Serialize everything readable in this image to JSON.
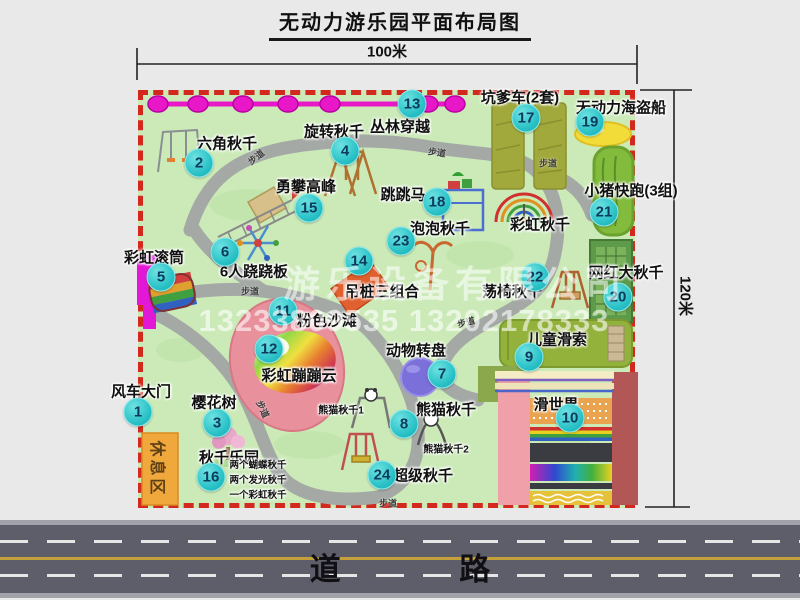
{
  "title": "无动力游乐园平面布局图",
  "dimensions": {
    "width_label": "100米",
    "height_label": "120米"
  },
  "road": {
    "label": "道  路"
  },
  "watermark": {
    "company": "游乐设备有限公司",
    "phones": "13233809535 13202178333"
  },
  "colors": {
    "park_green": "#cbeab8",
    "border_red": "#d3281e",
    "badge_teal": "#2cc3c8",
    "path_gray": "#a4a9a6",
    "zipline_magenta": "#e818c8",
    "road_gray": "#5e5e6a",
    "beach_pink": "#e8909c",
    "rest_orange": "#f0a83c"
  },
  "park": {
    "attractions": [
      {
        "num": 1,
        "label": "风车大门",
        "lx": 141,
        "ly": 391,
        "bx": 138,
        "by": 412
      },
      {
        "num": 2,
        "label": "六角秋千",
        "lx": 227,
        "ly": 143,
        "bx": 199,
        "by": 163
      },
      {
        "num": 3,
        "label": "樱花树",
        "lx": 214,
        "ly": 402,
        "bx": 217,
        "by": 423
      },
      {
        "num": 4,
        "label": "旋转秋千",
        "lx": 334,
        "ly": 131,
        "bx": 345,
        "by": 151
      },
      {
        "num": 5,
        "label": "彩虹滚筒",
        "lx": 154,
        "ly": 257,
        "bx": 161,
        "by": 277
      },
      {
        "num": 6,
        "label": "6人跷跷板",
        "lx": 254,
        "ly": 271,
        "bx": 225,
        "by": 252
      },
      {
        "num": 7,
        "label": "动物转盘",
        "lx": 416,
        "ly": 350,
        "bx": 442,
        "by": 374
      },
      {
        "num": 8,
        "label": "熊猫秋千",
        "lx": 446,
        "ly": 409,
        "bx": 404,
        "by": 424
      },
      {
        "num": 9,
        "label": "儿童滑索",
        "lx": 557,
        "ly": 339,
        "bx": 529,
        "by": 357
      },
      {
        "num": 10,
        "label": "滑世界",
        "lx": 556,
        "ly": 404,
        "bx": 570,
        "by": 418
      },
      {
        "num": 11,
        "label": "粉色沙滩",
        "lx": 327,
        "ly": 320,
        "bx": 283,
        "by": 311
      },
      {
        "num": 12,
        "label": "彩虹蹦蹦云",
        "lx": 299,
        "ly": 375,
        "bx": 269,
        "by": 349
      },
      {
        "num": 13,
        "label": "丛林穿越",
        "lx": 400,
        "ly": 126,
        "bx": 412,
        "by": 104
      },
      {
        "num": 14,
        "label": "吊桩三组合",
        "lx": 382,
        "ly": 291,
        "bx": 359,
        "by": 261
      },
      {
        "num": 15,
        "label": "勇攀高峰",
        "lx": 306,
        "ly": 186,
        "bx": 309,
        "by": 208
      },
      {
        "num": 16,
        "label": "秋千乐园",
        "lx": 229,
        "ly": 457,
        "bx": 211,
        "by": 477
      },
      {
        "num": 17,
        "label": "坑爹车(2套)",
        "lx": 520,
        "ly": 97,
        "bx": 526,
        "by": 118
      },
      {
        "num": 18,
        "label": "跳跳马",
        "lx": 403,
        "ly": 194,
        "bx": 437,
        "by": 202
      },
      {
        "num": 19,
        "label": "无动力海盗船",
        "lx": 621,
        "ly": 107,
        "bx": 590,
        "by": 122
      },
      {
        "num": 20,
        "label": "网红大秋千",
        "lx": 626,
        "ly": 272,
        "bx": 618,
        "by": 297
      },
      {
        "num": 21,
        "label": "小猪快跑(3组)",
        "lx": 631,
        "ly": 190,
        "bx": 604,
        "by": 212
      },
      {
        "num": 22,
        "label": "荡椅秋千",
        "lx": 512,
        "ly": 291,
        "bx": 535,
        "by": 277
      },
      {
        "num": 23,
        "label": "泡泡秋千",
        "lx": 440,
        "ly": 228,
        "bx": 401,
        "by": 241
      },
      {
        "num": 24,
        "label": "超级秋千",
        "lx": 423,
        "ly": 475,
        "bx": 382,
        "by": 475
      }
    ],
    "extra_labels": [
      {
        "text": "彩虹秋千",
        "x": 540,
        "y": 224,
        "size": 15
      },
      {
        "text": "熊猫秋千1",
        "x": 341,
        "y": 409,
        "size": 10
      },
      {
        "text": "熊猫秋千2",
        "x": 446,
        "y": 448,
        "size": 10
      }
    ],
    "rest_area_label": "休息区",
    "swing_park_details": [
      "两个蝴蝶秋千",
      "两个发光秋千",
      "一个彩虹秋千"
    ],
    "walk_path_label": "步道",
    "walk_path_positions": [
      {
        "x": 256,
        "y": 157,
        "rot": -38
      },
      {
        "x": 437,
        "y": 152,
        "rot": 8
      },
      {
        "x": 548,
        "y": 163,
        "rot": 0
      },
      {
        "x": 250,
        "y": 291,
        "rot": 0
      },
      {
        "x": 466,
        "y": 322,
        "rot": -15
      },
      {
        "x": 263,
        "y": 409,
        "rot": 65
      },
      {
        "x": 388,
        "y": 503,
        "rot": 0
      }
    ]
  }
}
